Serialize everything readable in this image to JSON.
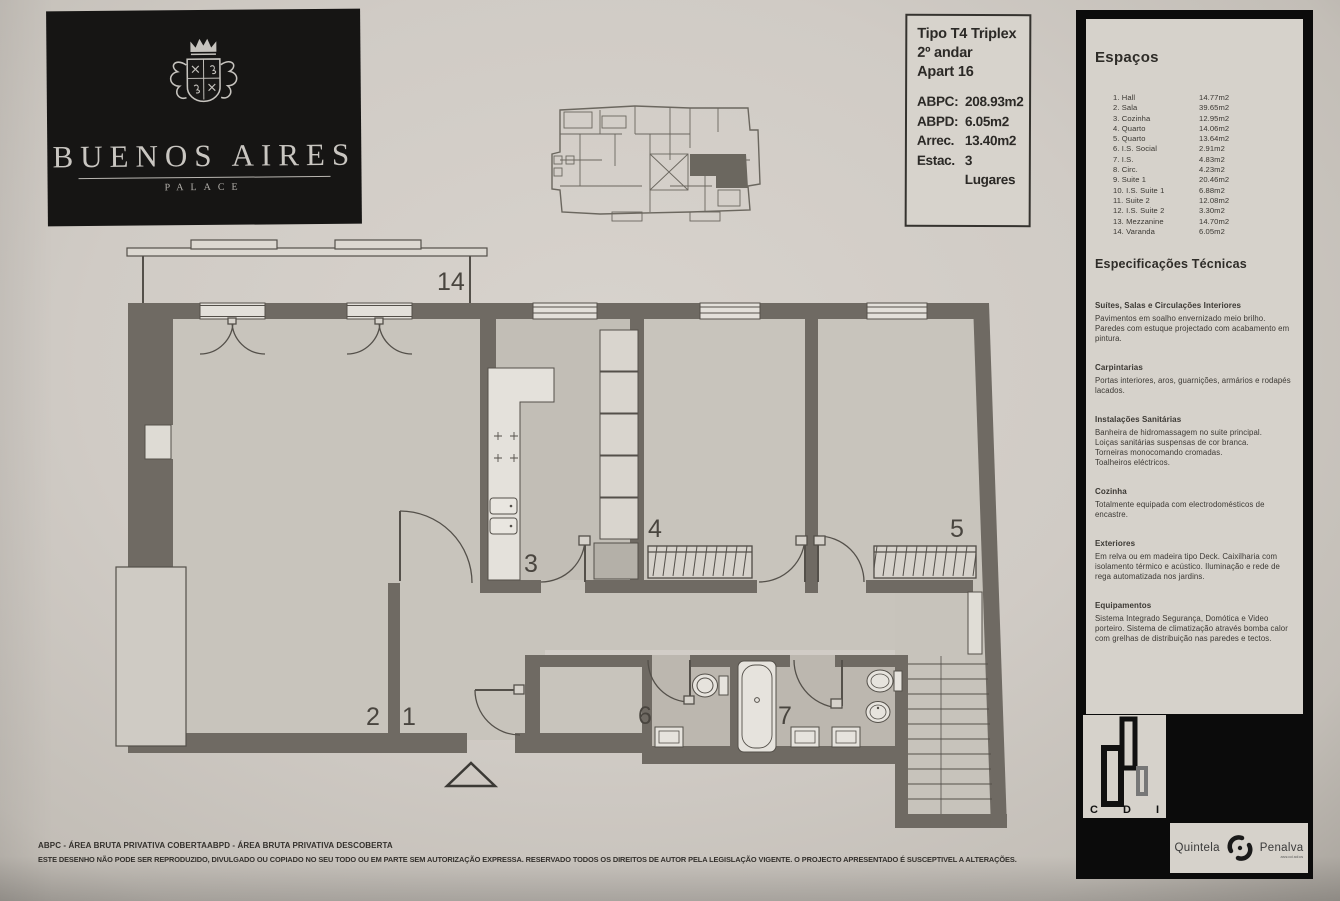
{
  "logo": {
    "title": "BUENOS AIRES",
    "subtitle": "PALACE"
  },
  "info_box": {
    "lines": [
      "Tipo T4 Triplex",
      "2º andar",
      "Apart 16"
    ],
    "metrics": [
      {
        "label": "ABPC:",
        "value": "208.93m2"
      },
      {
        "label": "ABPD:",
        "value": "6.05m2"
      },
      {
        "label": "Arrec.",
        "value": "13.40m2"
      },
      {
        "label": "Estac.",
        "value": "3 Lugares"
      }
    ]
  },
  "spaces": {
    "title": "Espaços",
    "items": [
      {
        "num": "1.",
        "name": "Hall",
        "area": "14.77m2"
      },
      {
        "num": "2.",
        "name": "Sala",
        "area": "39.65m2"
      },
      {
        "num": "3.",
        "name": "Cozinha",
        "area": "12.95m2"
      },
      {
        "num": "4.",
        "name": "Quarto",
        "area": "14.06m2"
      },
      {
        "num": "5.",
        "name": "Quarto",
        "area": "13.64m2"
      },
      {
        "num": "6.",
        "name": "I.S. Social",
        "area": "2.91m2"
      },
      {
        "num": "7.",
        "name": "I.S.",
        "area": "4.83m2"
      },
      {
        "num": "8.",
        "name": "Circ.",
        "area": "4.23m2"
      },
      {
        "num": "9.",
        "name": "Suite 1",
        "area": "20.46m2"
      },
      {
        "num": "10.",
        "name": "I.S. Suite 1",
        "area": "6.88m2"
      },
      {
        "num": "11.",
        "name": "Suite 2",
        "area": "12.08m2"
      },
      {
        "num": "12.",
        "name": "I.S. Suite 2",
        "area": "3.30m2"
      },
      {
        "num": "13.",
        "name": "Mezzanine",
        "area": "14.70m2"
      },
      {
        "num": "14.",
        "name": "Varanda",
        "area": "6.05m2"
      }
    ]
  },
  "specs": {
    "title": "Especificações Técnicas",
    "sections": [
      {
        "heading": "Suítes, Salas e Circulações Interiores",
        "lines": [
          "Pavimentos em soalho envernizado meio brilho.",
          "Paredes com estuque projectado com acabamento em pintura."
        ]
      },
      {
        "heading": "Carpintarias",
        "lines": [
          "Portas interiores, aros, guarnições, armários e rodapés lacados."
        ]
      },
      {
        "heading": "Instalações Sanitárias",
        "lines": [
          "Banheira de hidromassagem no suite principal.",
          "Loiças sanitárias suspensas de cor branca.",
          "Torneiras monocomando cromadas.",
          "Toalheiros eléctricos."
        ]
      },
      {
        "heading": "Cozinha",
        "lines": [
          "Totalmente equipada com electrodomésticos de encastre."
        ]
      },
      {
        "heading": "Exteriores",
        "lines": [
          "Em relva ou em madeira tipo Deck. Caixilharia com isolamento térmico e acústico. Iluminação e rede de rega automatizada nos jardins."
        ]
      },
      {
        "heading": "Equipamentos",
        "lines": [
          "Sistema Integrado Segurança, Domótica e Video porteiro. Sistema de climatização através bomba calor com grelhas de distribuição nas paredes e tectos."
        ]
      }
    ]
  },
  "branding": {
    "cdi_letters": [
      "C",
      "D",
      "I"
    ],
    "agency": {
      "name1": "Quintela",
      "name2": "Penalva",
      "sub": "associados"
    }
  },
  "plan": {
    "labels": {
      "varanda": "14",
      "sala": "2",
      "hall": "1",
      "cozinha": "3",
      "quarto4": "4",
      "quarto5": "5",
      "is_social": "6",
      "is": "7"
    }
  },
  "footer": {
    "abbr1": "ABPC - ÁREA BRUTA PRIVATIVA COBERTA",
    "abbr2": "ABPD - ÁREA BRUTA PRIVATIVA DESCOBERTA",
    "legal": "ESTE DESENHO NÃO PODE SER REPRODUZIDO, DIVULGADO OU COPIADO NO SEU TODO OU EM PARTE SEM AUTORIZAÇÃO EXPRESSA. RESERVADO TODOS OS DIREITOS DE AUTOR PELA LEGISLAÇÃO VIGENTE. O PROJECTO APRESENTADO É SUSCEPTIVEL A ALTERAÇÕES."
  },
  "colors": {
    "wall": "#6f6a63",
    "line": "#54504a",
    "paper": "#d0cbc5",
    "panel_black": "#0b0b0b"
  }
}
